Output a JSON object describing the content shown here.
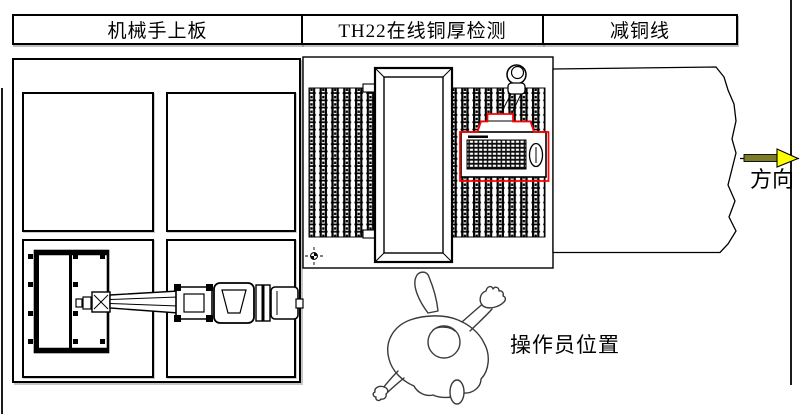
{
  "header": {
    "cells": [
      {
        "label": "机械手上板"
      },
      {
        "label": "TH22在线铜厚检测"
      },
      {
        "label": "减铜线"
      }
    ]
  },
  "annotations": {
    "direction_label": "方向",
    "operator_label": "操作员位置"
  },
  "colors": {
    "line": "#000000",
    "background": "#ffffff",
    "highlight_red": "#ff0000",
    "arrow_head_yellow": "#ffff00",
    "arrow_shaft_olive": "#7c7c28"
  }
}
